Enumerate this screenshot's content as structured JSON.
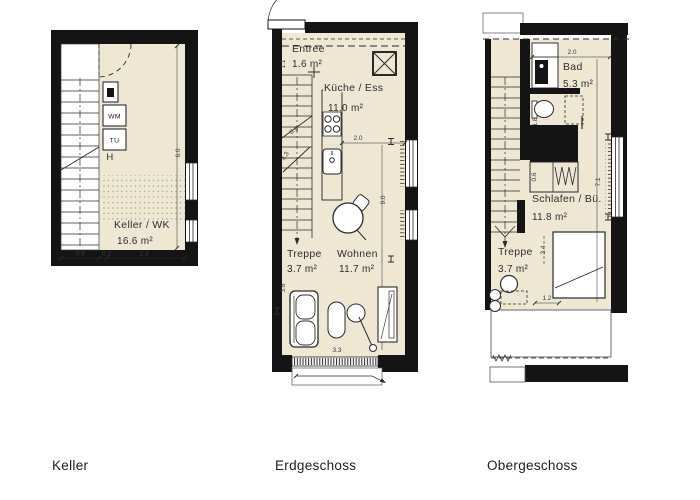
{
  "colors": {
    "floor": "#EDE7D3",
    "wall": "#141414",
    "line": "#2c2c2c",
    "background": "#ffffff"
  },
  "captions": {
    "keller": "Keller",
    "erdgeschoss": "Erdgeschoss",
    "obergeschoss": "Obergeschoss"
  },
  "keller": {
    "room_name": "Keller / WK",
    "room_area": "16.6 m²",
    "washer_label": "WM",
    "dryer_label": "TU",
    "h_label": "H",
    "dim_bottom_1": "0.9",
    "dim_bottom_2": "0.2",
    "dim_bottom_3": "2.3",
    "dim_right": "6.0"
  },
  "erdgeschoss": {
    "entree_name": "Entree",
    "entree_area": "1.6 m²",
    "kueche_name": "Küche / Ess",
    "kueche_area": "11.0 m²",
    "treppe_name": "Treppe",
    "treppe_area": "3.7 m²",
    "wohnen_name": "Wohnen",
    "wohnen_area": "11.7 m²",
    "dim_left_top": "1.1",
    "dim_stair_run": "0.9",
    "dim_stair_height": "4.3",
    "dim_kitchen": "2.0",
    "dim_right": "9.0",
    "dim_left_bottom": "3.6",
    "dim_bottom": "3.3"
  },
  "obergeschoss": {
    "bad_name": "Bad",
    "bad_area": "5.3 m²",
    "schlafen_name": "Schlafen / Bü.",
    "schlafen_area": "11.8 m²",
    "treppe_name": "Treppe",
    "treppe_area": "3.7 m²",
    "dim_top": "2.0",
    "dim_wc": "1.8",
    "dim_wardrobe": "0.6",
    "dim_right": "7.1",
    "dim_mid": "3.4",
    "dim_bottom": "1.2"
  }
}
